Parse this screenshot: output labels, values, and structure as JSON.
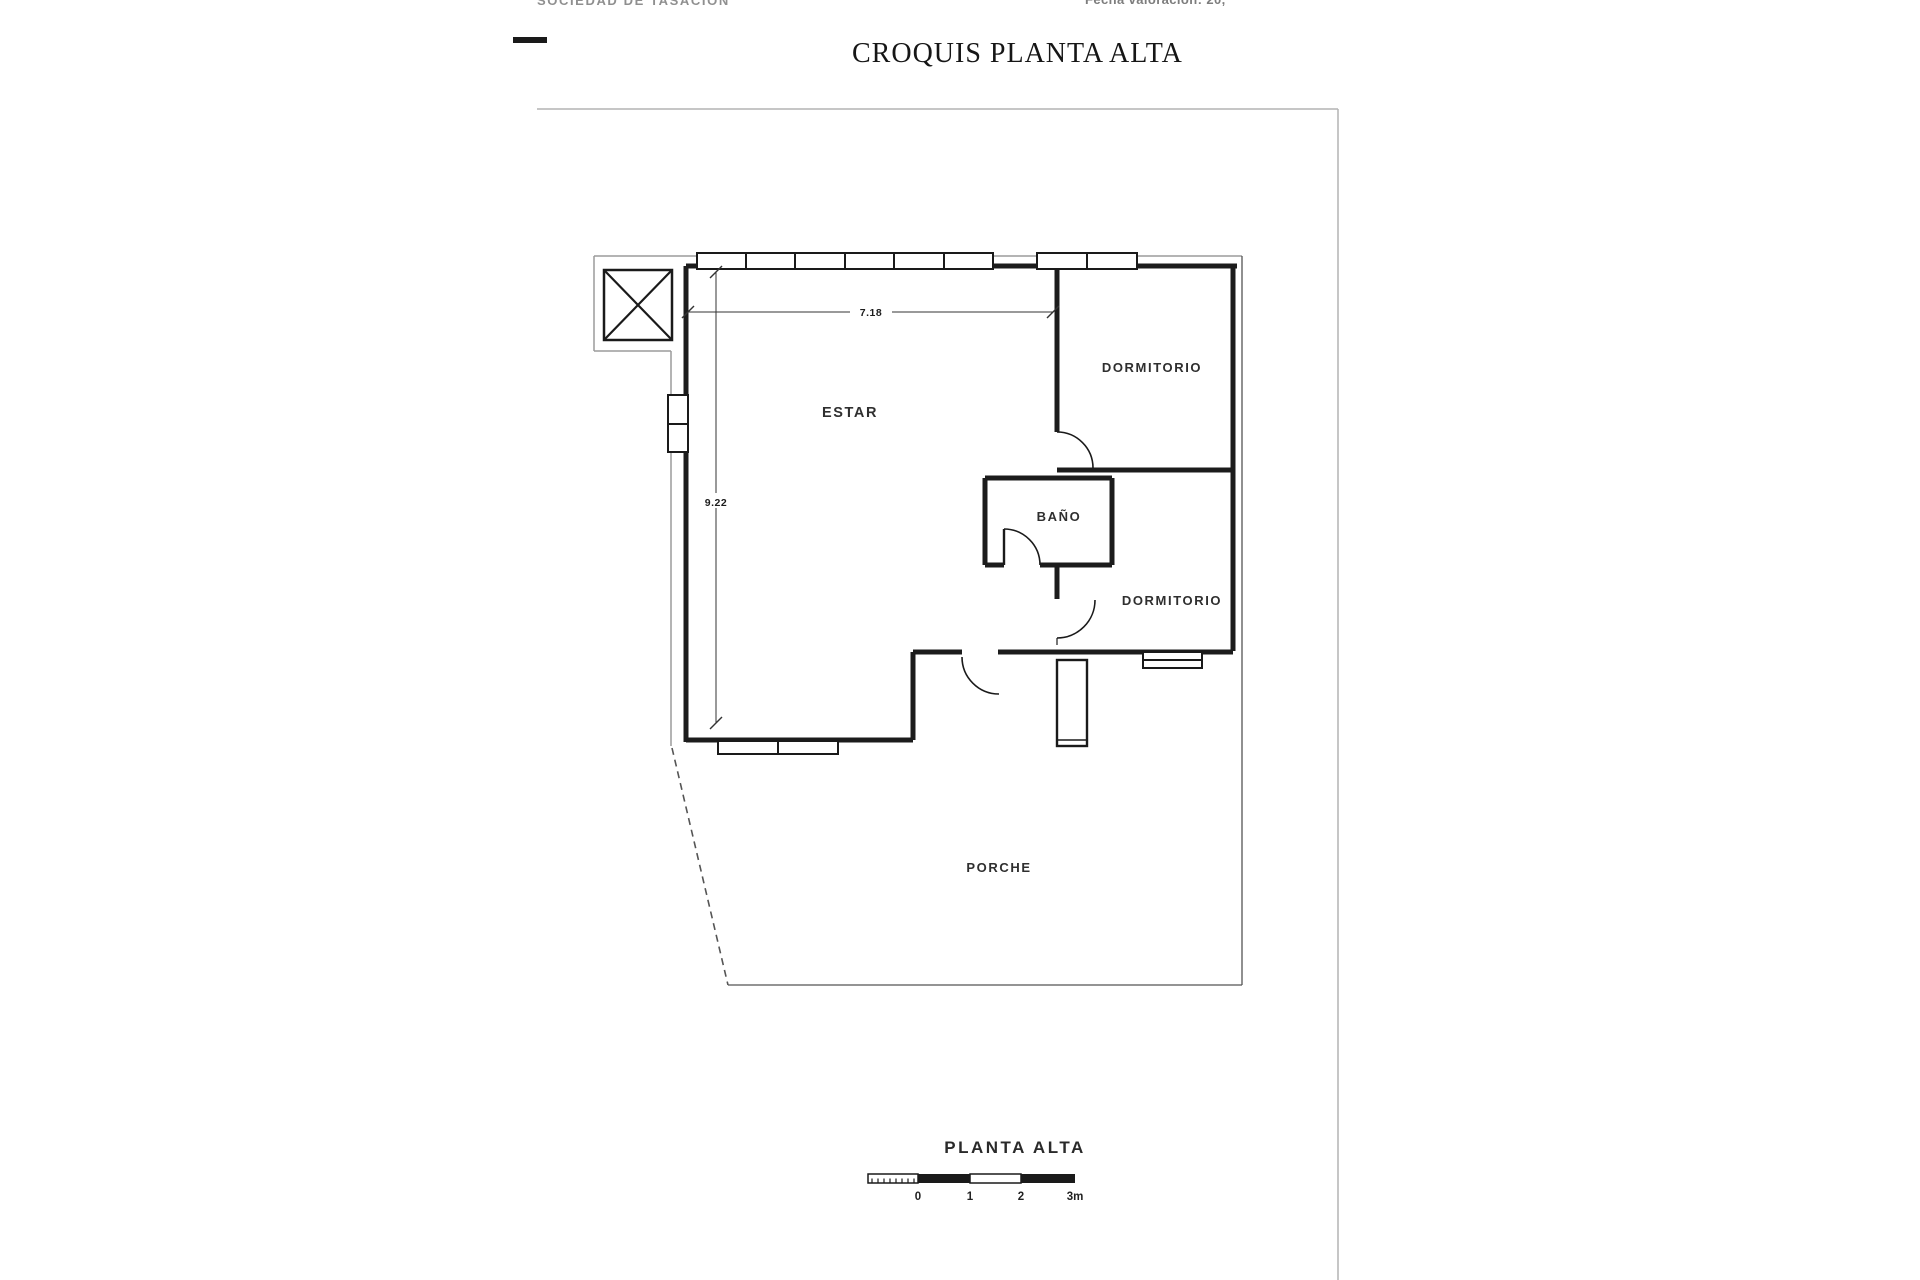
{
  "header": {
    "top_left_partial": "SOCIEDAD DE TASACIÓN",
    "top_right_partial": "Fecha valoración: 20,",
    "title": "CROQUIS PLANTA ALTA"
  },
  "footer": {
    "label": "PLANTA ALTA",
    "scale_ticks": [
      "0",
      "1",
      "2",
      "3m"
    ]
  },
  "colors": {
    "ink": "#1a1a1a",
    "wall": "#1c1c1c",
    "thin": "#555555",
    "gray": "#9b9b9b",
    "page_border": "#b3b3b3",
    "dim": "#333333"
  },
  "plan": {
    "room_labels": [
      {
        "text": "ESTAR",
        "x": 850,
        "y": 417,
        "size": 14.5
      },
      {
        "text": "DORMITORIO",
        "x": 1152,
        "y": 372,
        "size": 13
      },
      {
        "text": "BAÑO",
        "x": 1059,
        "y": 521,
        "size": 13
      },
      {
        "text": "DORMITORIO",
        "x": 1172,
        "y": 605,
        "size": 13
      },
      {
        "text": "PORCHE",
        "x": 999,
        "y": 872,
        "size": 13
      }
    ],
    "dim_labels": [
      {
        "text": "7.18",
        "x": 871,
        "y": 316,
        "bg": [
          850,
          303,
          42,
          15
        ]
      },
      {
        "text": "9.22",
        "x": 716,
        "y": 506,
        "bg": [
          697,
          493,
          38,
          15
        ]
      }
    ],
    "dim_lines": [
      [
        688,
        312,
        1053,
        312
      ],
      [
        716,
        272,
        716,
        723
      ]
    ],
    "dim_ticks": [
      [
        682,
        318,
        694,
        306
      ],
      [
        1047,
        318,
        1059,
        306
      ],
      [
        710,
        278,
        722,
        266
      ],
      [
        710,
        729,
        722,
        717
      ]
    ],
    "walls": [
      [
        686,
        266,
        1237,
        266,
        5
      ],
      [
        686,
        266,
        686,
        397,
        5
      ],
      [
        686,
        450,
        686,
        742,
        5
      ],
      [
        1233,
        268,
        1233,
        651,
        5
      ],
      [
        1057,
        268,
        1057,
        432,
        5
      ],
      [
        1057,
        470,
        1233,
        470,
        5
      ],
      [
        985,
        478,
        1112,
        478,
        5
      ],
      [
        985,
        478,
        985,
        565,
        5
      ],
      [
        1112,
        478,
        1112,
        565,
        5
      ],
      [
        985,
        565,
        1004,
        565,
        5
      ],
      [
        1040,
        565,
        1112,
        565,
        5
      ],
      [
        1057,
        565,
        1057,
        599,
        5
      ],
      [
        913,
        652,
        962,
        652,
        5
      ],
      [
        998,
        652,
        1233,
        652,
        5
      ],
      [
        913,
        652,
        913,
        740,
        5
      ],
      [
        686,
        740,
        913,
        740,
        5
      ]
    ],
    "windows": [
      {
        "x": 697,
        "y": 253,
        "w": 296,
        "h": 16,
        "dividers": [
          746,
          795,
          845,
          894,
          944
        ],
        "dir": "v"
      },
      {
        "x": 1037,
        "y": 253,
        "w": 100,
        "h": 16,
        "dividers": [
          1087
        ],
        "dir": "v"
      },
      {
        "x": 668,
        "y": 395,
        "w": 20,
        "h": 57,
        "dividers": [
          424
        ],
        "dir": "h"
      },
      {
        "x": 718,
        "y": 741,
        "w": 120,
        "h": 13,
        "dividers": [
          778
        ],
        "dir": "v"
      },
      {
        "x": 1143,
        "y": 652,
        "w": 59,
        "h": 16,
        "dividers": [
          660
        ],
        "dir": "h"
      }
    ],
    "door_arcs": [
      "M 1057 432 A 36 36 0 0 1 1093 468",
      "M 1004 529 A 36 36 0 0 1 1040 565",
      "M 1095 600 A 38 38 0 0 1 1057 638",
      "M 962 657 A 37 37 0 0 0 999 694"
    ],
    "door_leaves": [
      [
        1004,
        565,
        1004,
        529
      ]
    ],
    "dashed_lines": [
      [
        672,
        748,
        728,
        985
      ],
      [
        1057,
        638,
        1057,
        652
      ]
    ],
    "gray_lines": [
      [
        697,
        256,
        594,
        256
      ],
      [
        594,
        256,
        594,
        351
      ],
      [
        594,
        351,
        671,
        351
      ],
      [
        671,
        351,
        671,
        746
      ],
      [
        993,
        256,
        1037,
        256
      ],
      [
        1137,
        256,
        1242,
        256
      ]
    ],
    "thin_lines": [
      [
        1242,
        256,
        1242,
        985
      ],
      [
        728,
        985,
        1242,
        985
      ]
    ],
    "page_border": [
      [
        537,
        109,
        1338,
        109
      ],
      [
        1338,
        109,
        1338,
        1280
      ]
    ],
    "shaft": {
      "x": 604,
      "y": 270,
      "w": 68,
      "h": 70
    },
    "stair": {
      "x": 1057,
      "y": 660,
      "w": 30,
      "h": 86
    },
    "logo_dash": {
      "x": 513,
      "y": 37,
      "w": 34,
      "h": 6
    },
    "footer_label_pos": {
      "x": 1015,
      "y": 1153,
      "size": 17
    },
    "scale_bar": {
      "y": 1174,
      "h": 9,
      "pre_x": 868,
      "x0": 918,
      "x1": 970,
      "x2": 1021,
      "x3": 1075,
      "label_y": 1200,
      "tick_xs": [
        918,
        970,
        1021,
        1075
      ]
    }
  }
}
